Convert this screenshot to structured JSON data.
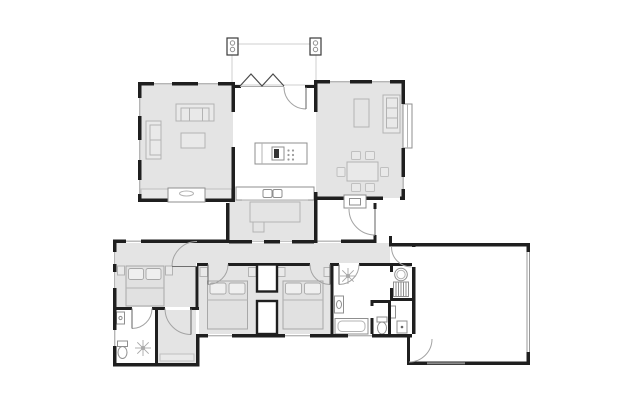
{
  "app": {
    "type": "architectural-floor-plan",
    "background": "#ffffff"
  },
  "palette": {
    "background": "#ffffff",
    "wall": "#1f1f1f",
    "floor": "#e4e4e4",
    "room_fill_light": "#e9e9e9",
    "furniture_stroke": "#b3b3b3",
    "fixture_stroke": "#8f8f8f",
    "bed_fill": "#e1e1e1",
    "window_glass": "#b5b5b5",
    "door_arc": "#a3a3a3",
    "deck_outline": "#cfcfcf",
    "garage_door": "#999999"
  },
  "plan": {
    "rooms": [
      {
        "id": "deck",
        "fixtures": [
          "pergola-post",
          "pergola-post"
        ]
      },
      {
        "id": "living-room",
        "fixtures": [
          "sofa",
          "chaise",
          "coffee-table",
          "fireplace",
          "window-seat",
          "window-seat"
        ]
      },
      {
        "id": "kitchen",
        "fixtures": [
          "island-cooktop",
          "bench",
          "double-sink",
          "bifold-door",
          "hinged-door"
        ]
      },
      {
        "id": "family-room",
        "fixtures": [
          "console",
          "sofa",
          "dining-table",
          "chair",
          "chair",
          "chair",
          "chair",
          "chair",
          "chair",
          "fireplace",
          "bay-window"
        ]
      },
      {
        "id": "courtyard",
        "fixtures": [
          "outdoor-table",
          "outdoor-seat"
        ]
      },
      {
        "id": "entry",
        "fixtures": [
          "front-door"
        ]
      },
      {
        "id": "hallway",
        "fixtures": []
      },
      {
        "id": "master-bedroom",
        "fixtures": [
          "double-bed",
          "pillow",
          "pillow",
          "bedside-table",
          "bedside-table"
        ]
      },
      {
        "id": "ensuite",
        "fixtures": [
          "basin",
          "toilet",
          "shower-rose"
        ]
      },
      {
        "id": "walk-in-robe",
        "fixtures": [
          "shelf"
        ]
      },
      {
        "id": "bedroom-2",
        "fixtures": [
          "double-bed",
          "pillow",
          "pillow",
          "bedside-table",
          "bedside-table",
          "wardrobe"
        ]
      },
      {
        "id": "bedroom-3",
        "fixtures": [
          "double-bed",
          "pillow",
          "pillow",
          "bedside-table",
          "bedside-table",
          "wardrobe"
        ]
      },
      {
        "id": "bathroom",
        "fixtures": [
          "shower-rose",
          "vanity",
          "bathtub"
        ]
      },
      {
        "id": "wc",
        "fixtures": [
          "toilet"
        ]
      },
      {
        "id": "laundry",
        "fixtures": [
          "laundry-tub",
          "appliance",
          "cupboard",
          "washer"
        ]
      },
      {
        "id": "garage",
        "fixtures": [
          "garage-door",
          "internal-door"
        ]
      }
    ],
    "door_swings": 10,
    "window_count": 14
  }
}
